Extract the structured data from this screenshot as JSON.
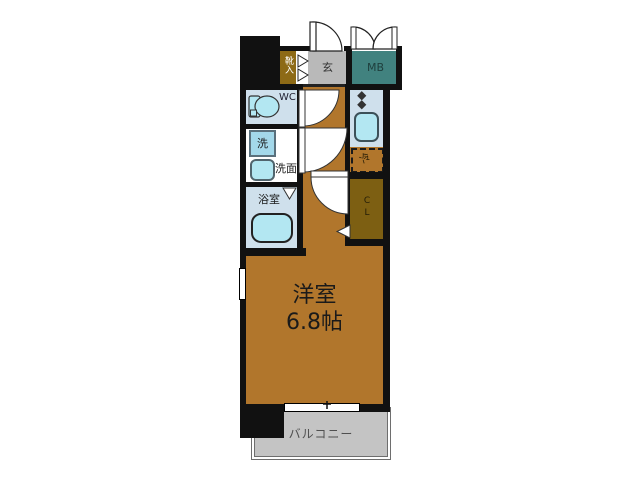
{
  "floor_plan": {
    "rooms": {
      "shoe_cabinet": "靴入",
      "entrance": "玄",
      "meter_box": "MB",
      "toilet": "WC",
      "washing_machine": "洗",
      "washroom": "洗面",
      "bathroom": "浴室",
      "refrigerator": "冷",
      "closet": "CL",
      "main_room_name": "洋室",
      "main_room_size": "6.8帖",
      "balcony": "バルコニー"
    },
    "colors": {
      "wall": "#111111",
      "wood_floor": "#b1762c",
      "shoe_cabinet": "#8d6a16",
      "closet_floor": "#7d5f12",
      "meter_box": "#41827f",
      "entrance_floor": "#b9b9b9",
      "wet_room": "#cfe0ec",
      "fixture": "#b3e7f2",
      "washer_box": "#a3d8ea",
      "balcony_floor": "#c4c4c4"
    }
  }
}
